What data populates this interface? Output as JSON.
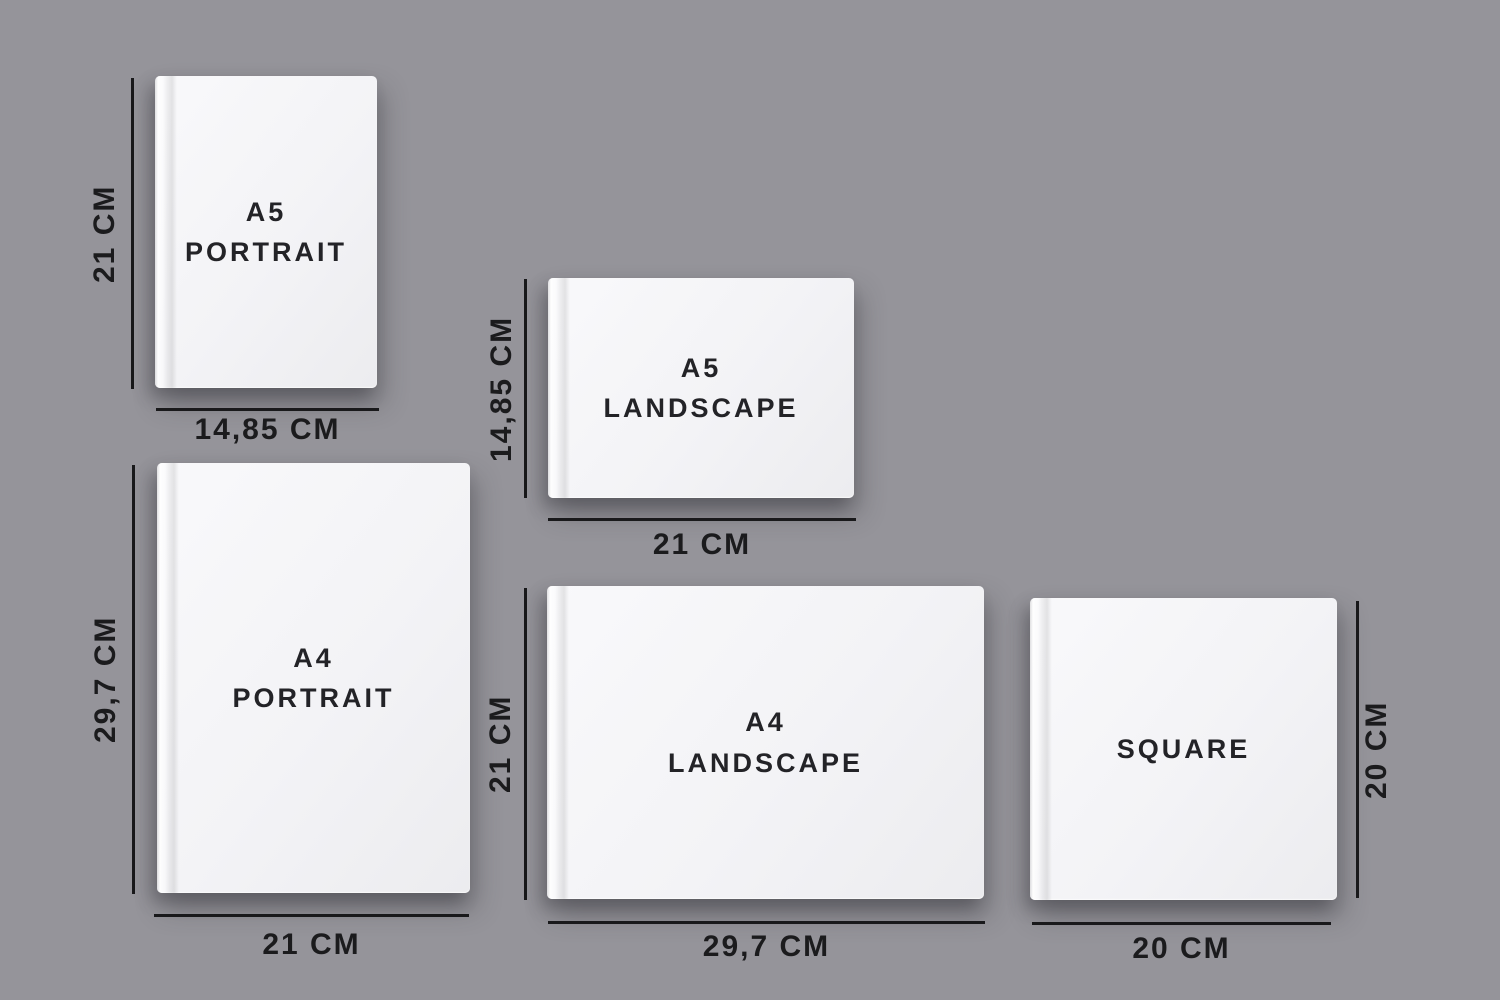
{
  "canvas": {
    "background_color": "#95949a",
    "line_color": "#19191b",
    "label_color": "#1b1b1d",
    "cover_color": "#f3f3f6",
    "cover_text_color": "#232327"
  },
  "books": [
    {
      "id": "a5-portrait",
      "title_line1": "A5",
      "title_line2": "PORTRAIT",
      "height_label": "21 CM",
      "width_label": "14,85 CM"
    },
    {
      "id": "a5-landscape",
      "title_line1": "A5",
      "title_line2": "LANDSCAPE",
      "height_label": "14,85 CM",
      "width_label": "21 CM"
    },
    {
      "id": "a4-portrait",
      "title_line1": "A4",
      "title_line2": "PORTRAIT",
      "height_label": "29,7 CM",
      "width_label": "21 CM"
    },
    {
      "id": "a4-landscape",
      "title_line1": "A4",
      "title_line2": "LANDSCAPE",
      "height_label": "21 CM",
      "width_label": "29,7 CM"
    },
    {
      "id": "square",
      "title_line1": "SQUARE",
      "title_line2": "",
      "height_label": "20 CM",
      "width_label": "20 CM"
    }
  ]
}
